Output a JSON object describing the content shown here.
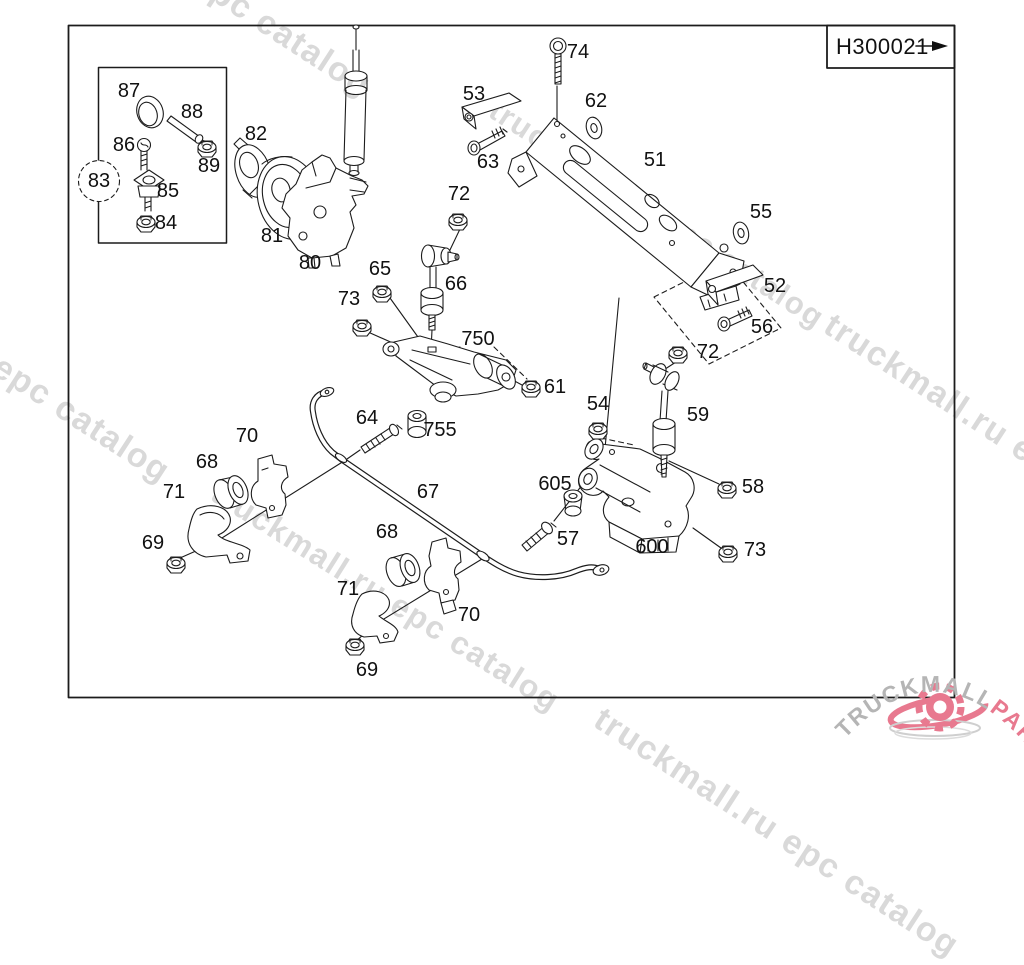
{
  "diagram": {
    "code": "H300021",
    "frame": {
      "stroke": "#111111"
    },
    "line_color": "#1c1c1c"
  },
  "watermark": {
    "text": "truckmall.ru epc catalog",
    "color": "#d9d9d9",
    "instances": [
      {
        "x": 20,
        "y": -160,
        "angle": 33,
        "size": 34
      },
      {
        "x": 502,
        "y": 92,
        "angle": 33,
        "size": 31
      },
      {
        "x": -181,
        "y": 226,
        "angle": 33,
        "size": 34
      },
      {
        "x": 224,
        "y": 474,
        "angle": 32,
        "size": 32
      },
      {
        "x": 838,
        "y": 306,
        "angle": 33,
        "size": 34
      },
      {
        "x": 608,
        "y": 700,
        "angle": 33,
        "size": 34
      }
    ]
  },
  "logo": {
    "brand_gray": "TRUCKMALL",
    "brand_pink": "PARTS",
    "gray": "#b5b5b5",
    "pink": "#e8798f"
  },
  "part_labels": [
    {
      "id": "74",
      "x": 578,
      "y": 52
    },
    {
      "id": "87",
      "x": 129,
      "y": 91
    },
    {
      "id": "53",
      "x": 474,
      "y": 94
    },
    {
      "id": "62",
      "x": 596,
      "y": 101
    },
    {
      "id": "88",
      "x": 192,
      "y": 112
    },
    {
      "id": "82",
      "x": 256,
      "y": 134
    },
    {
      "id": "86",
      "x": 124,
      "y": 145
    },
    {
      "id": "51",
      "x": 655,
      "y": 160
    },
    {
      "id": "63",
      "x": 488,
      "y": 162
    },
    {
      "id": "89",
      "x": 209,
      "y": 166
    },
    {
      "id": "83",
      "x": 99,
      "y": 181
    },
    {
      "id": "85",
      "x": 168,
      "y": 191
    },
    {
      "id": "72",
      "x": 459,
      "y": 194
    },
    {
      "id": "55",
      "x": 761,
      "y": 212
    },
    {
      "id": "84",
      "x": 166,
      "y": 223
    },
    {
      "id": "81",
      "x": 272,
      "y": 236
    },
    {
      "id": "80",
      "x": 310,
      "y": 263
    },
    {
      "id": "65",
      "x": 380,
      "y": 269
    },
    {
      "id": "66",
      "x": 456,
      "y": 284
    },
    {
      "id": "52",
      "x": 775,
      "y": 286
    },
    {
      "id": "73",
      "x": 349,
      "y": 299
    },
    {
      "id": "56",
      "x": 762,
      "y": 327
    },
    {
      "id": "750",
      "x": 478,
      "y": 339
    },
    {
      "id": "72",
      "x": 708,
      "y": 352
    },
    {
      "id": "61",
      "x": 555,
      "y": 387
    },
    {
      "id": "54",
      "x": 598,
      "y": 404
    },
    {
      "id": "59",
      "x": 698,
      "y": 415
    },
    {
      "id": "64",
      "x": 367,
      "y": 418
    },
    {
      "id": "755",
      "x": 440,
      "y": 430
    },
    {
      "id": "70",
      "x": 247,
      "y": 436
    },
    {
      "id": "68",
      "x": 207,
      "y": 462
    },
    {
      "id": "605",
      "x": 555,
      "y": 484
    },
    {
      "id": "58",
      "x": 753,
      "y": 487
    },
    {
      "id": "67",
      "x": 428,
      "y": 492
    },
    {
      "id": "71",
      "x": 174,
      "y": 492
    },
    {
      "id": "68",
      "x": 387,
      "y": 532
    },
    {
      "id": "57",
      "x": 568,
      "y": 539
    },
    {
      "id": "69",
      "x": 153,
      "y": 543
    },
    {
      "id": "600",
      "x": 652,
      "y": 547
    },
    {
      "id": "73",
      "x": 755,
      "y": 550
    },
    {
      "id": "71",
      "x": 348,
      "y": 589
    },
    {
      "id": "70",
      "x": 469,
      "y": 615
    },
    {
      "id": "69",
      "x": 367,
      "y": 670
    }
  ]
}
